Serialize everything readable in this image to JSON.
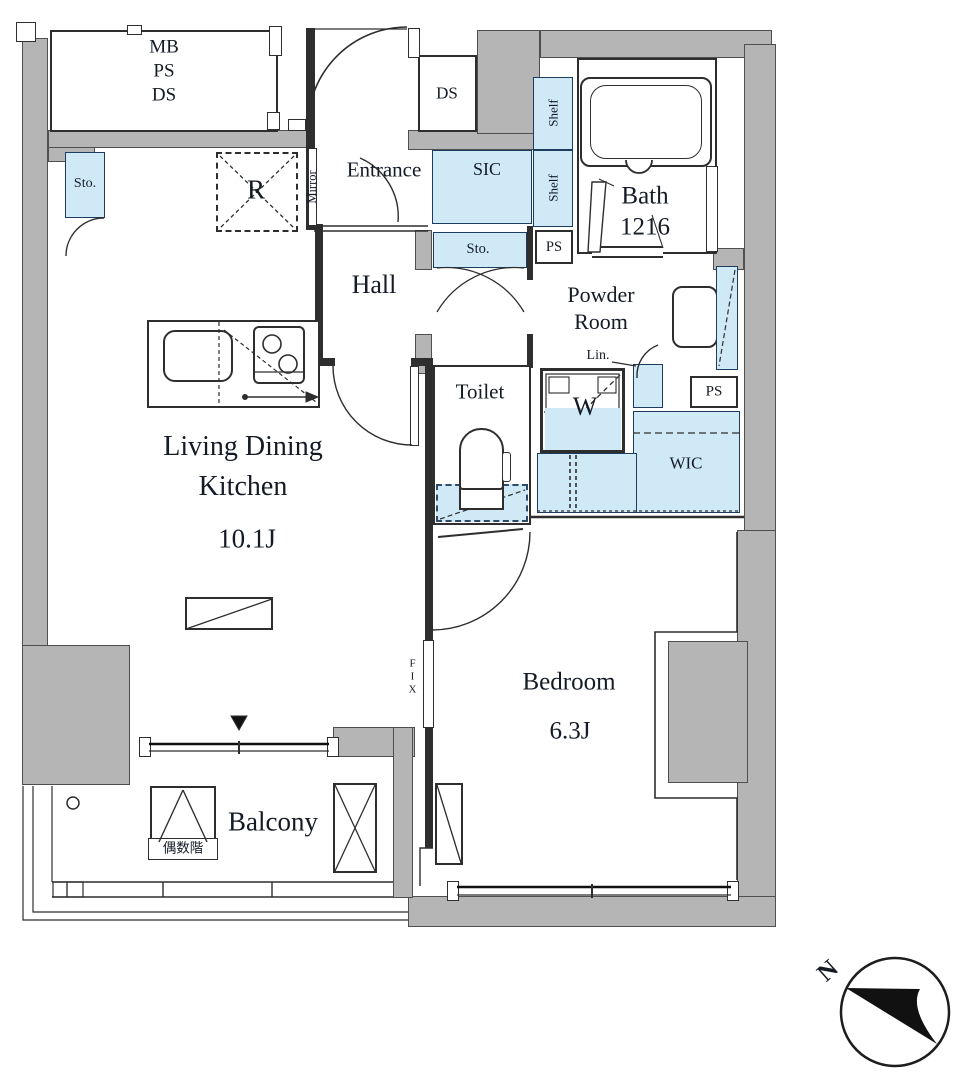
{
  "plan": {
    "colors": {
      "wall": "#b5b5b5",
      "storage_fill": "#cfe9f7",
      "line": "#2e2e2e",
      "text": "#141b26"
    },
    "labels": {
      "mb": "MB",
      "ps": "PS",
      "ds": "DS",
      "sto": "Sto.",
      "refrigerator": "R",
      "mirror": "Mirror",
      "entrance": "Entrance",
      "sic": "SIC",
      "shelf": "Shelf",
      "hall": "Hall",
      "lin": "Lin.",
      "washer": "W",
      "wic": "WIC",
      "toilet": "Toilet",
      "fix": "FIX",
      "even_floors": "偶数階",
      "north": "N"
    },
    "rooms": {
      "bath": {
        "name": "Bath",
        "size": "1216"
      },
      "powder": {
        "line1": "Powder",
        "line2": "Room"
      },
      "ldk": {
        "line1": "Living Dining",
        "line2": "Kitchen",
        "size": "10.1J"
      },
      "bedroom": {
        "name": "Bedroom",
        "size": "6.3J"
      },
      "balcony": "Balcony"
    }
  }
}
